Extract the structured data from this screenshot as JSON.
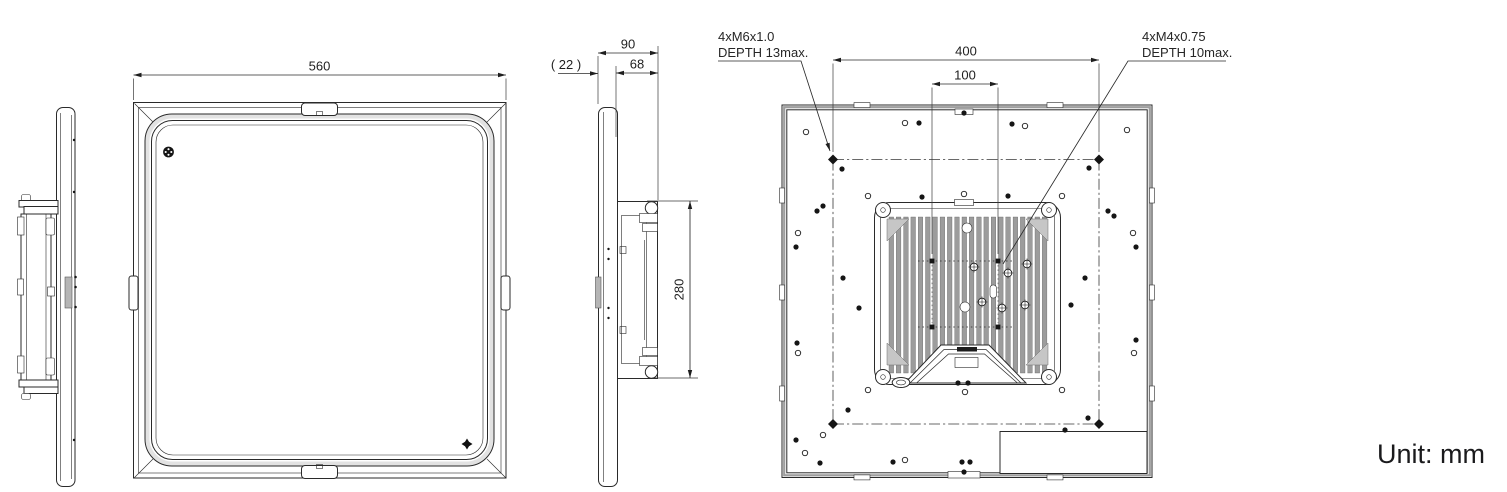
{
  "unit_label": "Unit: mm",
  "callouts": {
    "m6": {
      "line1": "4xM6x1.0",
      "line2": "DEPTH 13max."
    },
    "m4": {
      "line1": "4xM4x0.75",
      "line2": "DEPTH 10max."
    }
  },
  "dimensions": [
    {
      "name": "front-width",
      "label": "560",
      "x1": 133.5,
      "y1": 75,
      "x2": 506,
      "y2": 75,
      "tx": 319.5,
      "ty": 70.5,
      "ext": [
        [
          133.5,
          78.5,
          133.5,
          100
        ],
        [
          506,
          78.5,
          506,
          100
        ]
      ]
    },
    {
      "name": "side-depth-total",
      "label": "90",
      "x1": 598,
      "y1": 53,
      "x2": 658,
      "y2": 53,
      "tx": 628,
      "ty": 48.5,
      "ext": [
        [
          598,
          56,
          598,
          104
        ],
        [
          658,
          46,
          658,
          200
        ]
      ]
    },
    {
      "name": "side-depth-rear",
      "label": "68",
      "x1": 616,
      "y1": 73,
      "x2": 658,
      "y2": 73,
      "tx": 637,
      "ty": 68.5,
      "ext": [
        [
          616,
          66,
          616,
          137
        ]
      ]
    },
    {
      "name": "side-depth-front",
      "label": "( 22 )",
      "x1": 558,
      "y1": 73.5,
      "x2": 598,
      "y2": 73.5,
      "tx": 566,
      "ty": 69,
      "single": true,
      "ext": []
    },
    {
      "name": "side-rear-height",
      "label": "280",
      "x1": 690,
      "y1": 201,
      "x2": 690,
      "y2": 378,
      "tx": 683.5,
      "ty": 289.5,
      "rot": -90,
      "ext": [
        [
          647,
          201,
          698,
          201
        ],
        [
          652,
          378,
          698,
          378
        ]
      ]
    },
    {
      "name": "rear-mount-span",
      "label": "400",
      "x1": 833,
      "y1": 60,
      "x2": 1099,
      "y2": 60,
      "tx": 966,
      "ty": 55.5,
      "ext": [
        [
          833,
          63.5,
          833,
          152
        ],
        [
          1099,
          63.5,
          1099,
          152
        ]
      ]
    },
    {
      "name": "rear-vesa-span",
      "label": "100",
      "x1": 932,
      "y1": 84,
      "x2": 998,
      "y2": 84,
      "tx": 965,
      "ty": 79.5,
      "ext": [
        [
          932,
          87.5,
          932,
          254
        ],
        [
          998,
          87.5,
          998,
          254
        ]
      ]
    }
  ],
  "leaders": [
    {
      "name": "m6-leader",
      "points": [
        [
          718,
          61
        ],
        [
          801,
          61
        ],
        [
          830,
          151
        ]
      ],
      "arrow": true
    },
    {
      "name": "m4-leader",
      "points": [
        [
          1226,
          61
        ],
        [
          1128,
          61
        ],
        [
          1003,
          264
        ]
      ],
      "arrow": false
    }
  ],
  "fins": {
    "x0": 889,
    "pitch": 7.3,
    "count": 22,
    "width": 4.6,
    "y0": 217,
    "y1": 373
  },
  "rear_holes": {
    "m6": [
      [
        833,
        159.5
      ],
      [
        1099,
        159.5
      ],
      [
        833,
        424
      ],
      [
        1099,
        424
      ]
    ],
    "m4": [
      [
        932,
        261
      ],
      [
        998,
        261
      ],
      [
        932,
        327
      ],
      [
        998,
        327
      ]
    ],
    "cross": [
      [
        974,
        267
      ],
      [
        1008,
        273
      ],
      [
        982,
        302
      ],
      [
        1002,
        308
      ],
      [
        1027,
        264
      ],
      [
        1025,
        305
      ]
    ],
    "filled": [
      [
        919,
        123
      ],
      [
        1012,
        124
      ],
      [
        964,
        113
      ],
      [
        842,
        169
      ],
      [
        1089,
        168
      ],
      [
        817,
        211
      ],
      [
        823,
        206
      ],
      [
        1108,
        211
      ],
      [
        1114,
        216
      ],
      [
        796,
        247
      ],
      [
        1136,
        247
      ],
      [
        922,
        197
      ],
      [
        1008,
        196
      ],
      [
        843,
        278
      ],
      [
        1085,
        278
      ],
      [
        859,
        308
      ],
      [
        1071,
        305
      ],
      [
        797,
        343
      ],
      [
        1136,
        340
      ],
      [
        848,
        410
      ],
      [
        1088,
        418
      ],
      [
        796,
        440
      ],
      [
        820,
        463
      ],
      [
        893,
        462
      ],
      [
        958,
        383
      ],
      [
        968,
        383
      ],
      [
        962,
        462
      ],
      [
        970,
        462
      ],
      [
        964,
        472
      ],
      [
        1065,
        430
      ]
    ],
    "open": [
      [
        806,
        132
      ],
      [
        905,
        123
      ],
      [
        1025,
        126
      ],
      [
        1127,
        130
      ],
      [
        868,
        196
      ],
      [
        1062,
        196
      ],
      [
        964,
        194
      ],
      [
        798,
        233
      ],
      [
        1133,
        233
      ],
      [
        798,
        353
      ],
      [
        1134,
        353
      ],
      [
        868,
        390
      ],
      [
        1062,
        390
      ],
      [
        823,
        435
      ],
      [
        805,
        453
      ],
      [
        905,
        460
      ],
      [
        965,
        392
      ]
    ]
  }
}
